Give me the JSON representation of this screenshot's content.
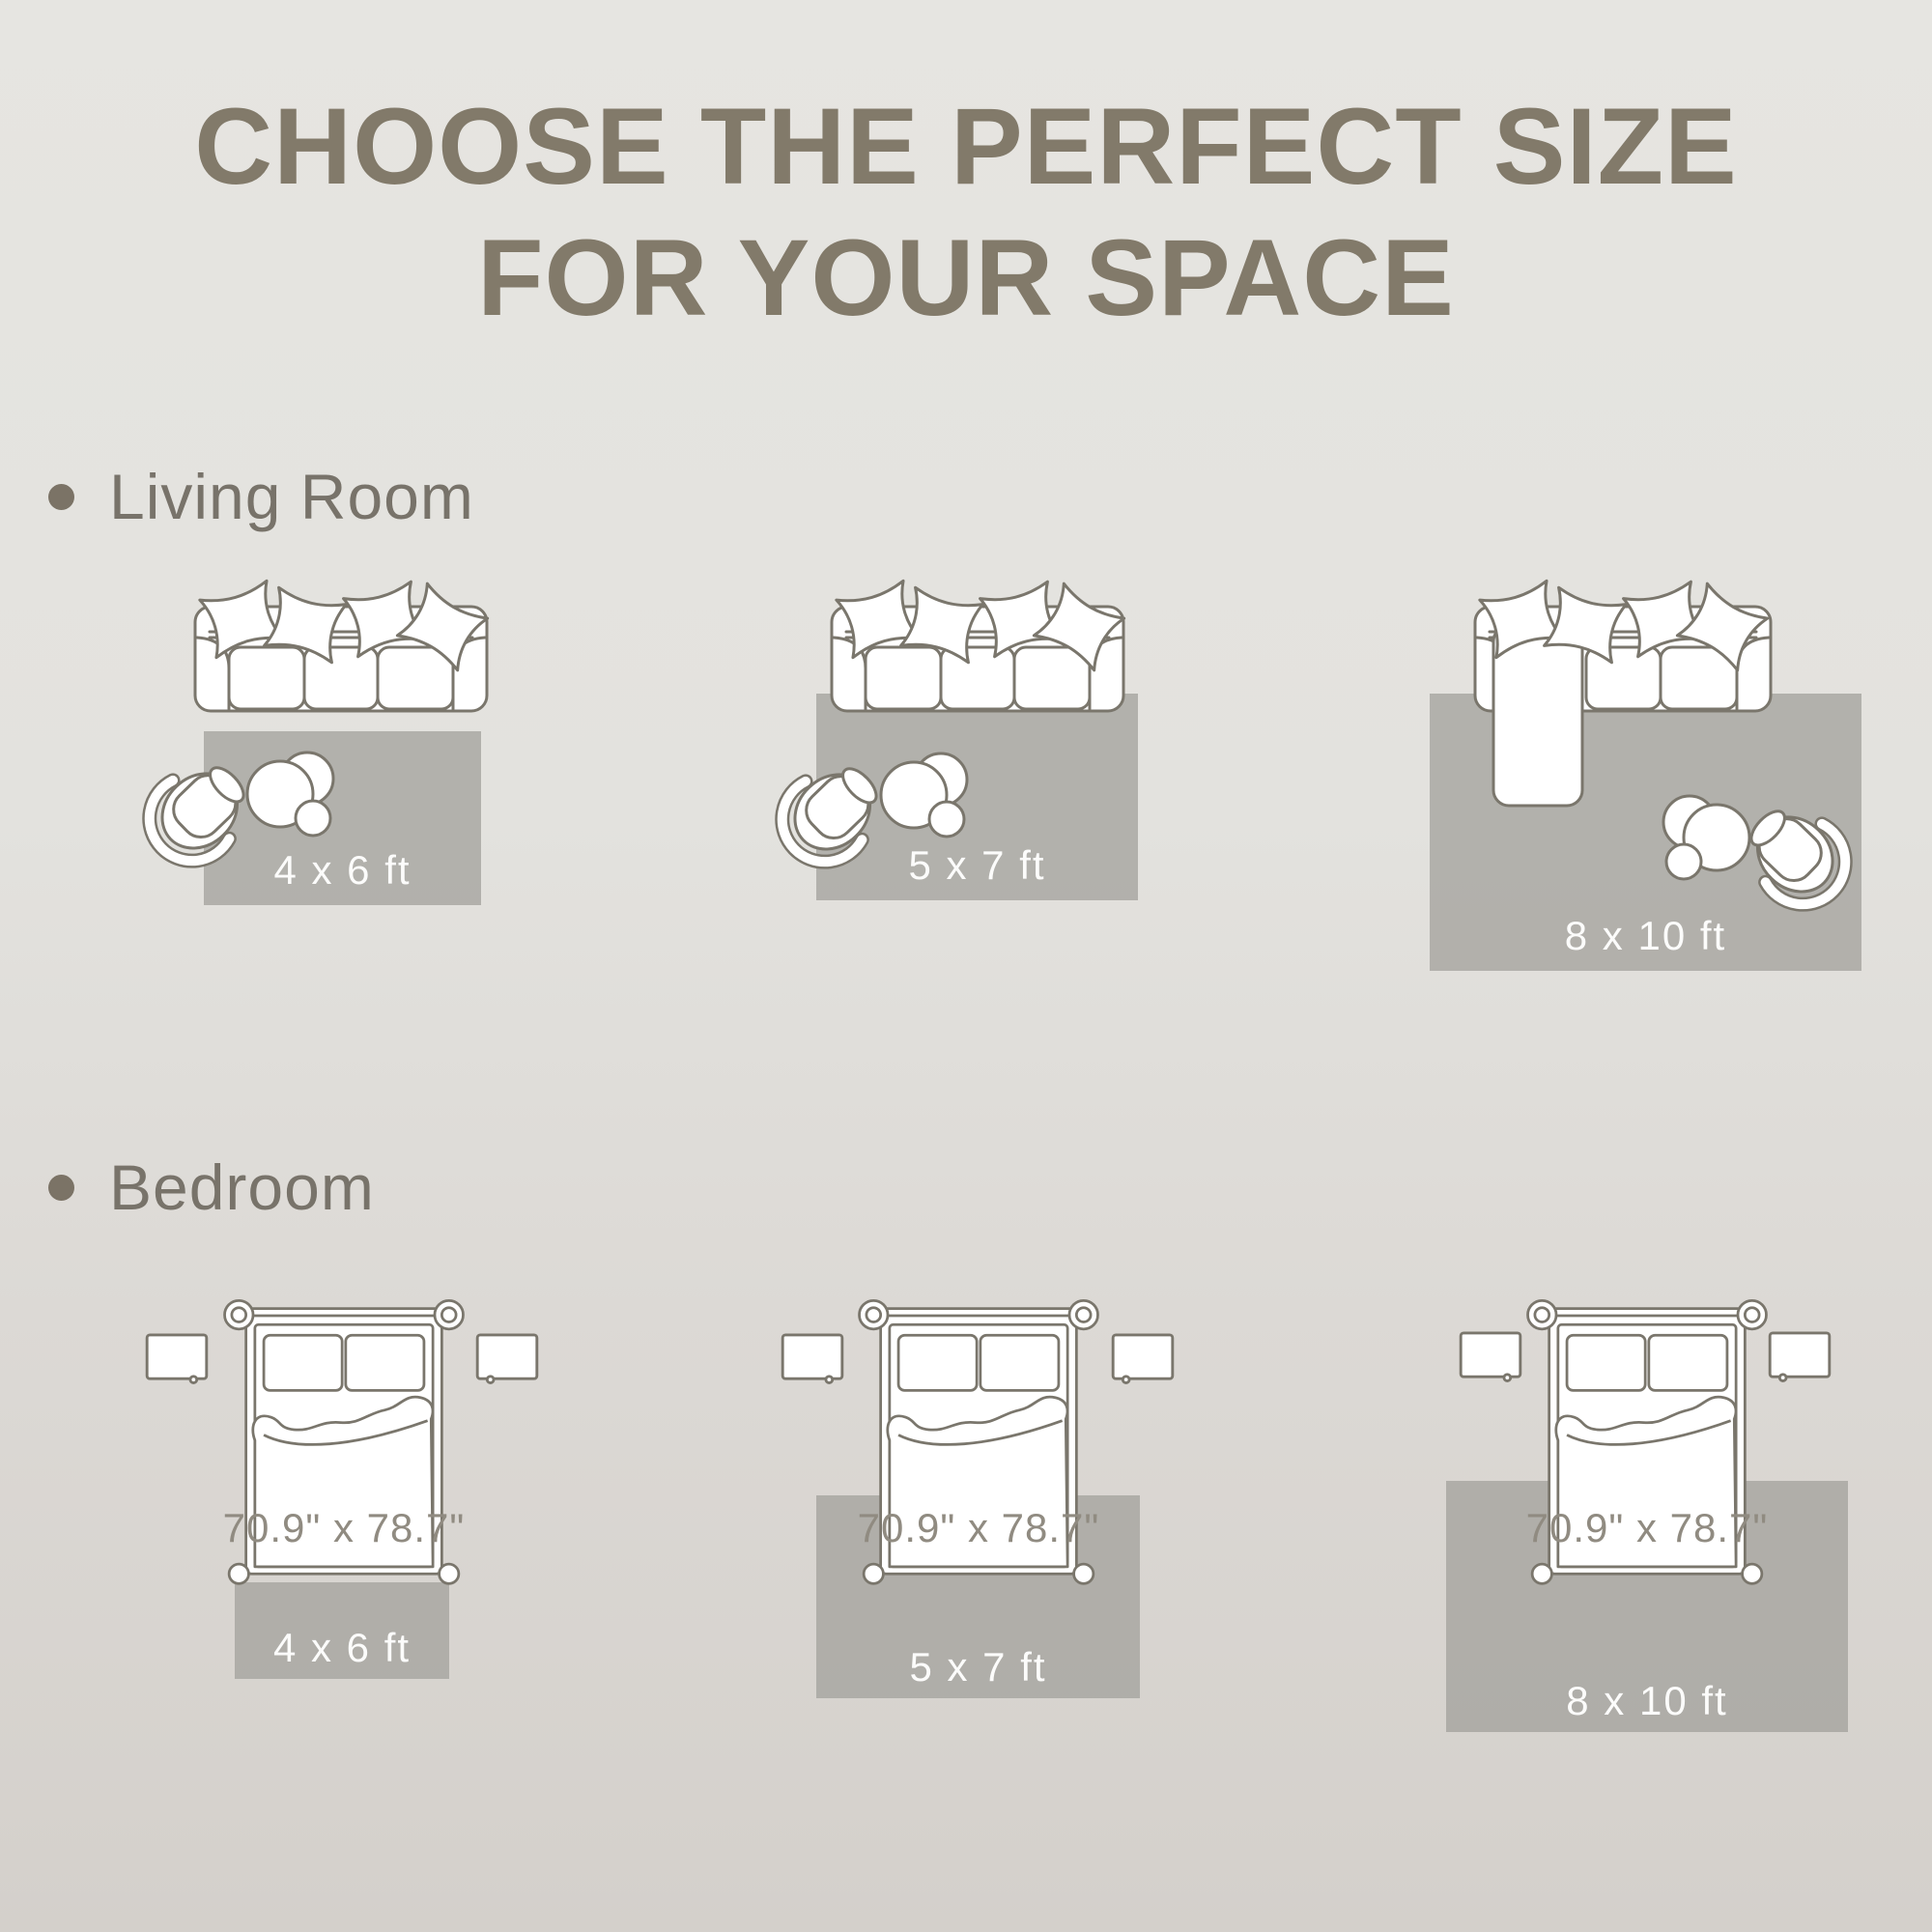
{
  "title": {
    "line1": "CHOOSE THE PERFECT SIZE",
    "line2": "FOR YOUR SPACE"
  },
  "sections": {
    "living_room": {
      "label": "Living Room",
      "tiles": [
        {
          "rug_label": "4 x 6 ft"
        },
        {
          "rug_label": "5 x 7 ft"
        },
        {
          "rug_label": "8 x 10 ft"
        }
      ]
    },
    "bedroom": {
      "label": "Bedroom",
      "tiles": [
        {
          "bed_label": "70.9\" x 78.7\"",
          "rug_label": "4 x 6 ft"
        },
        {
          "bed_label": "70.9\" x 78.7\"",
          "rug_label": "5 x 7 ft"
        },
        {
          "bed_label": "70.9\" x 78.7\"",
          "rug_label": "8 x 10 ft"
        }
      ]
    }
  },
  "colors": {
    "background_top": "#e6e5e1",
    "background_bottom": "#d4d0cb",
    "title_text": "#827a6a",
    "section_text": "#78736a",
    "bullet": "#7b7366",
    "furniture_outline": "#7a766c",
    "furniture_fill": "#ffffff",
    "rug_fill": "#b2b1ac",
    "rug_label_text": "#fcfcfb",
    "bed_label_text": "#908b81"
  }
}
